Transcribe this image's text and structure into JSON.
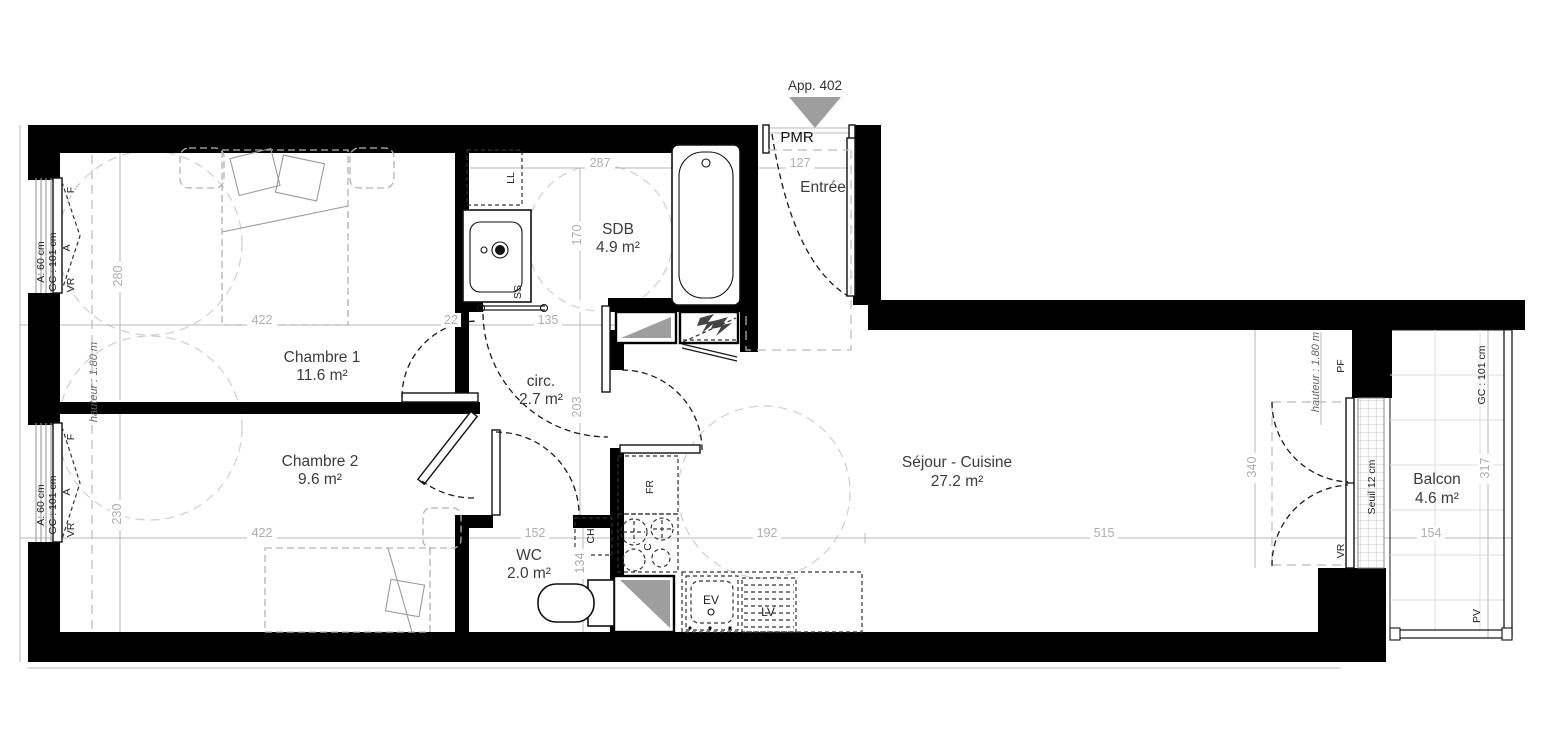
{
  "plan": {
    "marker": {
      "label": "App. 402"
    },
    "entrance_tag": "PMR",
    "rooms": {
      "entree": {
        "name": "Entrée"
      },
      "sdb": {
        "name": "SDB",
        "area": "4.9 m²"
      },
      "chambre1": {
        "name": "Chambre 1",
        "area": "11.6 m²"
      },
      "chambre2": {
        "name": "Chambre 2",
        "area": "9.6 m²"
      },
      "circ": {
        "name": "circ.",
        "area": "2.7 m²"
      },
      "wc": {
        "name": "WC",
        "area": "2.0 m²"
      },
      "sejour": {
        "name": "Séjour - Cuisine",
        "area": "27.2 m²"
      },
      "balcon": {
        "name": "Balcon",
        "area": "4.6 m²"
      }
    },
    "dims": {
      "d287": "287",
      "d127": "127",
      "d170": "170",
      "d422a": "422",
      "d22": "22",
      "d135": "135",
      "d280": "280",
      "d230": "230",
      "d422b": "422",
      "d152": "152",
      "d134": "134",
      "d203": "203",
      "d192": "192",
      "d515": "515",
      "d340": "340",
      "d317": "317",
      "d154": "154"
    },
    "annotations": {
      "window_a": "A: 60 cm",
      "window_gc": "GC : 101 cm",
      "f": "F",
      "a": "A",
      "vr": "VR",
      "hauteur": "hauteur : 1.80 m",
      "pf": "PF",
      "pv": "PV",
      "seuil": "Seuil 12 cm",
      "ll": "LL",
      "ss": "SS",
      "ch": "CH",
      "fr": "FR",
      "c": "C",
      "ev": "EV",
      "lv": "LV"
    },
    "colors": {
      "wall": "#000000",
      "dim": "#aeaeae",
      "shaft": "#9e9e9e"
    }
  }
}
